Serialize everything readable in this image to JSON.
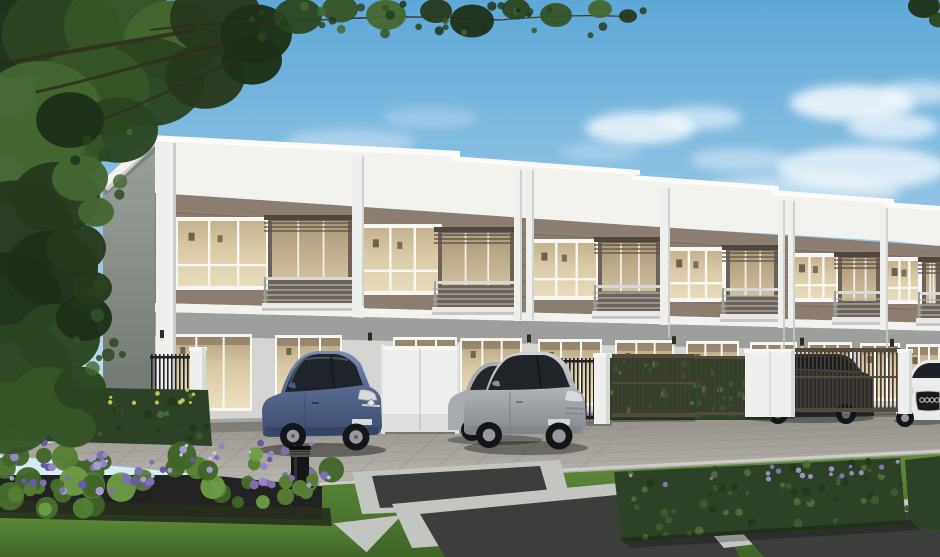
{
  "image": {
    "kind": "architectural exterior rendering",
    "subject": "Row of modern two-storey townhouses with front carports, metal gates, parked cars and landscaped street foreground",
    "time_of_day": "day",
    "text_visible": "none"
  },
  "palette": {
    "sky_top": "#5fa8d8",
    "sky_mid": "#9ccbe8",
    "sky_low": "#d6eef7",
    "cloud": "#ffffff",
    "foliage_dark": "#1e3018",
    "foliage": "#2a4420",
    "foliage_mid": "#365427",
    "foliage_light": "#44662f",
    "branch": "#332b1f",
    "fascia": "#f2f2ef",
    "cornice": "#fbfbf9",
    "band_brown": "#8b7d70",
    "band_groove": "#6e6257",
    "band_highlight": "#9e9184",
    "side_wall": "#9ba29c",
    "side_wall_dark": "#6d746d",
    "fin": "#eef0ee",
    "fin_shade": "#c9cbc7",
    "frame_white": "#f6f6f4",
    "glass_warm": "#d9cba6",
    "glass_warm_dark": "#b3a27e",
    "pic_frame": "#55483c",
    "balcony_back": "#6e6258",
    "railing": "#aeb2b0",
    "rail_top": "#d6d9d6",
    "pergola": "#4f463d",
    "gf_wall": "#d4d5d2",
    "gf_shadow": "#8e918e",
    "plinth": "#9c9d99",
    "fence_black": "#222226",
    "pillar_white": "#eff0ee",
    "gate_bronze": "#463c32",
    "gate_bronze_frame": "#55493c",
    "hedge": "#2c4126",
    "hedge_light": "#3f5c30",
    "road_dark": "#8f8c85",
    "road": "#a3a099",
    "road_light": "#bab7b0",
    "curb": "#d2d4cf",
    "grass": "#5f8d3a",
    "grass_dark": "#3f6526",
    "flower_purple": "#7f70b4",
    "flower_purple_light": "#a79ad0",
    "flower_yellow": "#d6cf4e",
    "soil": "#272f1d",
    "asphalt": "#3b3e3b",
    "concrete": "#c3c6c0",
    "car_blue": "#5c6e96",
    "car_blue_dark": "#3c4a6c",
    "car_silver": "#b2b5b9",
    "car_silver_far": "#a8acb0",
    "car_dark_suv": "#2b2d30",
    "car_white": "#e9ebed",
    "tire": "#141517",
    "rim": "#96999e",
    "window_tint": "#1f242c",
    "headlight": "#d6dade",
    "lamp_black": "#141517"
  },
  "scene": {
    "sky": {
      "description": "clear blue sky, light clouds on the right",
      "cloud_count": 12
    },
    "trees": {
      "position": "top-left corner canopy and left edge mass, small leaves along top edge and top-right corner"
    },
    "building": {
      "storeys": 2,
      "visible_units": 6,
      "roof_steps": 5,
      "upper_band": "brown horizontal siding with white fascia above",
      "unit_features": [
        "white-framed picture window",
        "recessed balcony with grey railing and pergola slats",
        "ground-floor glass sliding doors with warm interior"
      ],
      "wall_lamps": 6
    },
    "fences": [
      {
        "type": "black picket fence",
        "position": "far left"
      },
      {
        "type": "white pillar",
        "position": "left of carport"
      },
      {
        "type": "white sliding gate",
        "position": "center-left"
      },
      {
        "type": "black picket fence",
        "position": "center, behind silver cars"
      },
      {
        "type": "bronze slat gate with hedge behind",
        "position": "center-right"
      },
      {
        "type": "white double pillar",
        "position": "right-center"
      },
      {
        "type": "bronze slat gate",
        "position": "right, dark suv behind"
      },
      {
        "type": "white pillar",
        "position": "far right"
      }
    ],
    "cars": [
      {
        "type": "hatchback",
        "color_name": "blue-grey",
        "color": "#5c6e96",
        "position": "front of left unit"
      },
      {
        "type": "hatchback",
        "color_name": "silver",
        "color": "#a8acb0",
        "position": "behind silver coupe"
      },
      {
        "type": "coupe",
        "color_name": "silver",
        "color": "#b2b5b9",
        "position": "center"
      },
      {
        "type": "suv",
        "color_name": "dark grey",
        "color": "#2b2d30",
        "position": "behind right gate"
      },
      {
        "type": "sedan",
        "color_name": "white",
        "color": "#e9ebed",
        "position": "far right edge"
      }
    ],
    "landscape": {
      "flower_bed": {
        "flower_color": "#7f70b4",
        "position": "bottom-left"
      },
      "hedge_with_yellow_flowers": {
        "position": "left, behind flower bed"
      },
      "hedge_box_with_purple_specks": {
        "position": "bottom center-right"
      },
      "lawn": {
        "position": "bottom-left and center"
      },
      "paths": "dark asphalt panels with light concrete borders",
      "bollard_lamp": {
        "color": "#141517",
        "position": "right end of flower bed"
      }
    }
  }
}
